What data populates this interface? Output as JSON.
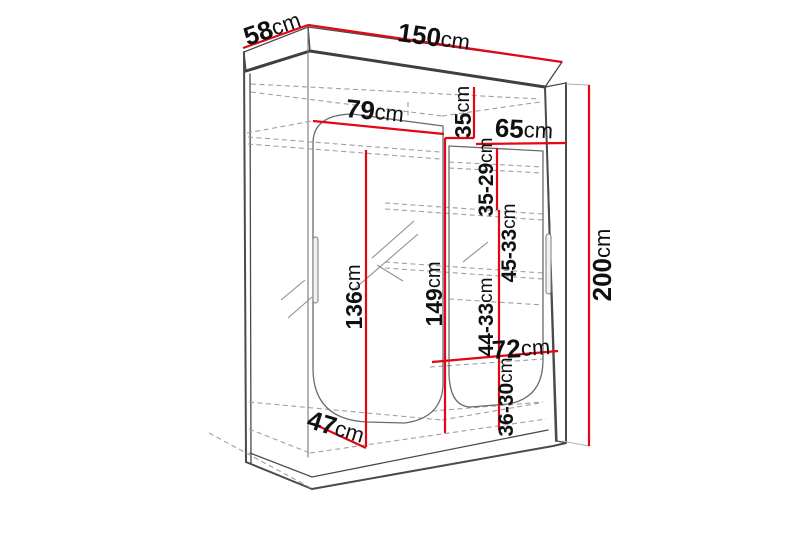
{
  "diagram": {
    "description": "Technical dimension drawing of a two-door sliding wardrobe with interior shelves",
    "unit": "cm"
  },
  "dims": {
    "depth_top": {
      "value": "58",
      "unit": "cm"
    },
    "width_top": {
      "value": "150",
      "unit": "cm"
    },
    "height_right": {
      "value": "200",
      "unit": "cm"
    },
    "left_section_width": {
      "value": "79",
      "unit": "cm"
    },
    "right_top_gap": {
      "value": "35",
      "unit": "cm"
    },
    "right_section_width": {
      "value": "65",
      "unit": "cm"
    },
    "right_gap_1": {
      "value": "35-29",
      "unit": "cm"
    },
    "right_gap_2": {
      "value": "45-33",
      "unit": "cm"
    },
    "left_door_height": {
      "value": "136",
      "unit": "cm"
    },
    "center_section_height": {
      "value": "149",
      "unit": "cm"
    },
    "right_gap_3": {
      "value": "44-33",
      "unit": "cm"
    },
    "bottom_shelf_width": {
      "value": "72",
      "unit": "cm"
    },
    "right_gap_4": {
      "value": "36-30",
      "unit": "cm"
    },
    "inner_depth_bottom": {
      "value": "47",
      "unit": "cm"
    }
  },
  "colors": {
    "background": "#ffffff",
    "dimension_line": "#e30613",
    "outline": "#4a4a4a",
    "outline_heavy": "#3f3f3f",
    "hidden_line": "#9f9f9f",
    "label_text": "#101010"
  }
}
